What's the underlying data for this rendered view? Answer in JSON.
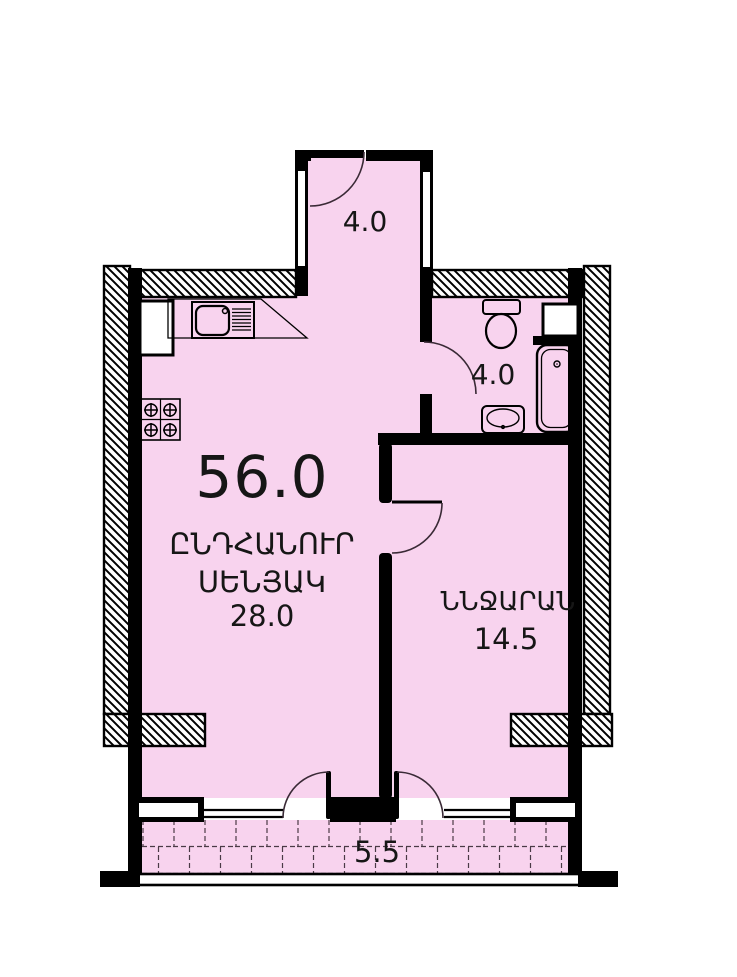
{
  "colors": {
    "room_fill": "#f8d3ee",
    "accent_red": "#ee1111",
    "wall": "#000000"
  },
  "total_area": "56.0",
  "rooms": {
    "hall": {
      "area": "4.0"
    },
    "bathroom": {
      "area": "4.0"
    },
    "living": {
      "label_line1": "ԸՆԴՀԱՆՈՒՐ",
      "label_line2": "ՍԵՆՅԱԿ",
      "area": "28.0"
    },
    "bedroom": {
      "label": "ՆՆՋԱՐԱՆ",
      "area": "14.5"
    },
    "balcony": {
      "area": "5.5"
    }
  }
}
